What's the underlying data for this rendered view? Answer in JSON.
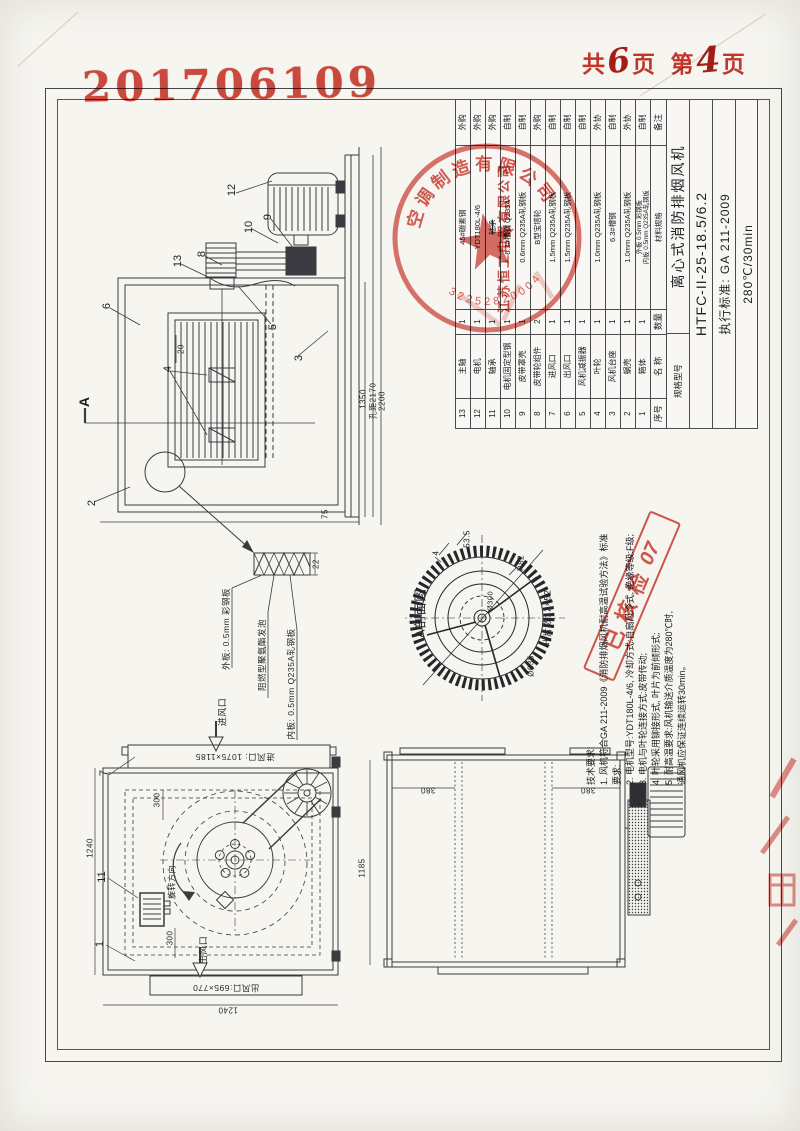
{
  "colors": {
    "stamp_red": "#c8372d",
    "line_ink": "#4a4a50",
    "paper": "#f6f5f0"
  },
  "header": {
    "doc_number": "201706109",
    "pagination": {
      "total_prefix": "共",
      "total_value": "6",
      "total_suffix": "页",
      "page_prefix": "第",
      "page_value": "4",
      "page_suffix": "页"
    }
  },
  "bom": {
    "headers": {
      "no": "序号",
      "name": "名 称",
      "qty": "数量",
      "material": "材料规格",
      "remark": "备注"
    },
    "rows": [
      {
        "no": "13",
        "name": "主轴",
        "qty": "1",
        "material": "45#碳素钢",
        "remark": "外购",
        "struck": false
      },
      {
        "no": "12",
        "name": "电机",
        "qty": "1",
        "material": "YDT180L-4/6",
        "remark": "外购",
        "struck": false
      },
      {
        "no": "11",
        "name": "轴承",
        "qty": "1",
        "material": "轴承",
        "remark": "外购",
        "struck": true
      },
      {
        "no": "10",
        "name": "电机固定型钢",
        "qty": "1",
        "material": "6.3#槽钢 Q235A",
        "remark": "自制",
        "struck": false
      },
      {
        "no": "9",
        "name": "皮带罩壳",
        "qty": "1",
        "material": "0.6mm Q235A轧钢板",
        "remark": "自制",
        "struck": false
      },
      {
        "no": "8",
        "name": "皮带轮组件",
        "qty": "2",
        "material": "B型宝塔轮",
        "remark": "外购",
        "struck": false
      },
      {
        "no": "7",
        "name": "进风口",
        "qty": "1",
        "material": "1.5mm Q235A轧钢板",
        "remark": "自制",
        "struck": false
      },
      {
        "no": "6",
        "name": "出风口",
        "qty": "1",
        "material": "1.5mm Q235A轧钢板",
        "remark": "自制",
        "struck": false
      },
      {
        "no": "5",
        "name": "风机减振器",
        "qty": "1",
        "material": "",
        "remark": "自制",
        "struck": false
      },
      {
        "no": "4",
        "name": "叶轮",
        "qty": "1",
        "material": "1.0mm Q235A轧钢板",
        "remark": "外协",
        "struck": false
      },
      {
        "no": "3",
        "name": "风机台座",
        "qty": "1",
        "material": "6.3#槽钢",
        "remark": "自制",
        "struck": false
      },
      {
        "no": "2",
        "name": "蜗壳",
        "qty": "1",
        "material": "1.0mm Q235A轧钢板",
        "remark": "外协",
        "struck": false
      },
      {
        "no": "1",
        "name": "箱体",
        "qty": "1",
        "material": "外板 0.5mm 彩钢板",
        "material2": "内板 0.5mm Q235A轧钢板",
        "remark": "自制",
        "struck": false
      }
    ]
  },
  "title_block": {
    "spec_label": "规格型号",
    "product_name": "离心式消防排烟风机",
    "model": "HTFC-II-25-18.5/6.2",
    "standard": "执行标准: GA 211-2009",
    "rating": "280℃/30min"
  },
  "tech_requirements": {
    "lines": [
      "技术要求:",
      "1. 风机符合GA 211-2009《消防排烟风机耐高温试验方法》标准",
      "    要求:",
      "2. 电机型号:YDT180L-4/6, 冷却方式:自扇风冷式, 绝缘等级:F级;",
      "3. 电机与叶轮连接方式:皮带传动;",
      "4. 叶轮采用铆接形式, 叶片为前倾形式;",
      "5. 耐高温要求:风机输送介质温度为280℃时,",
      "    通风机应保证连续运转30min。"
    ]
  },
  "stamps": {
    "circle_ring_text": "空调制造有限公司",
    "circle_digits": "32252820004",
    "company_line": "江苏恒工电器有限公司",
    "check_text": "已核检",
    "check_number": "07"
  },
  "section_view": {
    "label": "A剖面图",
    "blade_note": "叶片数: 2×52",
    "dim_53": "53.5",
    "dim_4": "4",
    "dim_r82": "R82",
    "dim_d300": "Ø300",
    "dim_d635": "Ø635"
  },
  "panel_detail": {
    "dim_22": "22",
    "label_outer": "外板: 0.5mm 彩钢板",
    "label_core": "阻燃型聚氨酯发泡",
    "label_inner": "内板: 0.5mm Q235A轧钢板"
  },
  "top_view": {
    "balloons": [
      "12",
      "10",
      "9",
      "13",
      "8",
      "6",
      "5",
      "3",
      "4",
      "2"
    ],
    "dim_1350": "1350",
    "dim_2170": "孔距2170",
    "dim_2200": "2200",
    "dim_20": "20",
    "dim_75": "75",
    "section_label": "A"
  },
  "plan_view": {
    "balloons": [
      "7",
      "11",
      "1"
    ],
    "inlet_label": "进风口",
    "inlet_size": "进风口: 1075×1185",
    "outlet_label": "出风口",
    "outlet_size": "出风口:695×770",
    "rotation_label": "旋转方向",
    "dim_300_top": "300",
    "dim_300_bottom": "300",
    "dim_1240_left": "1240",
    "dim_1240_bottom": "1240"
  },
  "elevation_view": {
    "dim_380_left": "380",
    "dim_380_right": "380",
    "dim_1185": "1185"
  }
}
